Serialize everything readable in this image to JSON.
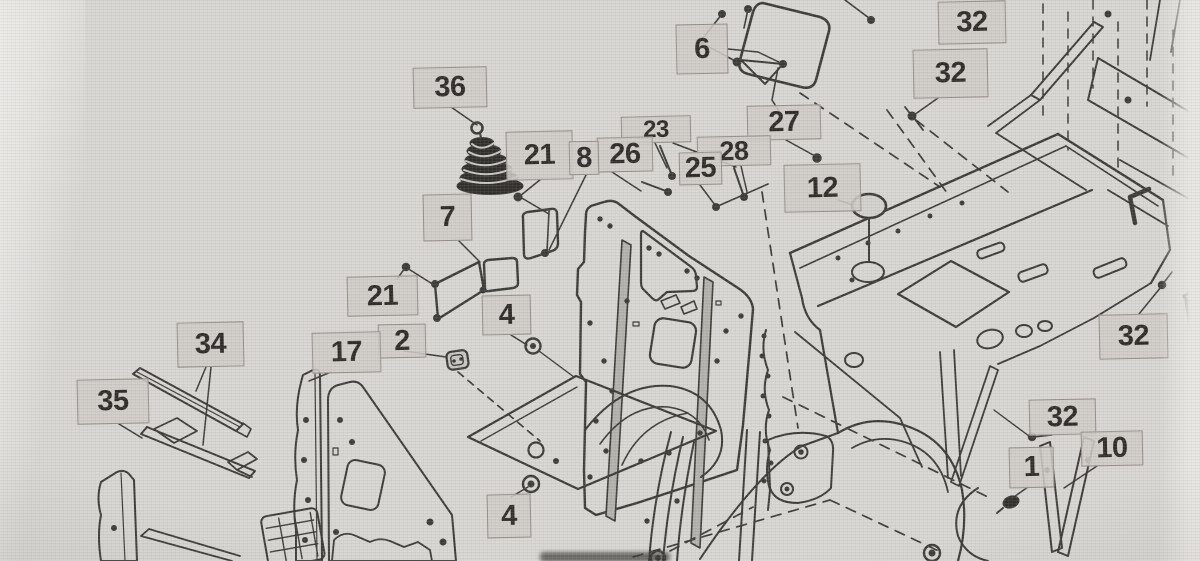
{
  "colors": {
    "background": "#d8d6d2",
    "line": "#3b3a36",
    "dark_fill": "#2f2e2b",
    "label_bg": "rgba(206,203,198,0.88)",
    "label_border": "#94918b",
    "label_text": "#2c2b28"
  },
  "labels": [
    {
      "id": "6",
      "text": "6",
      "x": 676,
      "y": 24,
      "w": 52,
      "h": 50
    },
    {
      "id": "32-top",
      "text": "32",
      "x": 938,
      "y": 1,
      "w": 68,
      "h": 43
    },
    {
      "id": "32-upper-right",
      "text": "32",
      "x": 913,
      "y": 49,
      "w": 75,
      "h": 49
    },
    {
      "id": "36",
      "text": "36",
      "x": 413,
      "y": 67,
      "w": 74,
      "h": 41
    },
    {
      "id": "27",
      "text": "27",
      "x": 747,
      "y": 105,
      "w": 74,
      "h": 35
    },
    {
      "id": "23",
      "text": "23",
      "x": 621,
      "y": 116,
      "w": 70,
      "h": 27
    },
    {
      "id": "26",
      "text": "26",
      "x": 597,
      "y": 137,
      "w": 56,
      "h": 35
    },
    {
      "id": "28",
      "text": "28",
      "x": 697,
      "y": 136,
      "w": 74,
      "h": 30
    },
    {
      "id": "25",
      "text": "25",
      "x": 679,
      "y": 152,
      "w": 43,
      "h": 33
    },
    {
      "id": "21-upper",
      "text": "21",
      "x": 506,
      "y": 131,
      "w": 67,
      "h": 49
    },
    {
      "id": "8",
      "text": "8",
      "x": 569,
      "y": 141,
      "w": 30,
      "h": 34
    },
    {
      "id": "12",
      "text": "12",
      "x": 784,
      "y": 164,
      "w": 77,
      "h": 48
    },
    {
      "id": "7",
      "text": "7",
      "x": 423,
      "y": 194,
      "w": 49,
      "h": 47
    },
    {
      "id": "21-lower",
      "text": "21",
      "x": 347,
      "y": 276,
      "w": 71,
      "h": 40
    },
    {
      "id": "4-upper",
      "text": "4",
      "x": 482,
      "y": 295,
      "w": 49,
      "h": 40
    },
    {
      "id": "2",
      "text": "2",
      "x": 378,
      "y": 324,
      "w": 48,
      "h": 34
    },
    {
      "id": "34",
      "text": "34",
      "x": 177,
      "y": 322,
      "w": 67,
      "h": 45
    },
    {
      "id": "17",
      "text": "17",
      "x": 312,
      "y": 332,
      "w": 69,
      "h": 41
    },
    {
      "id": "35",
      "text": "35",
      "x": 77,
      "y": 379,
      "w": 72,
      "h": 45
    },
    {
      "id": "4-lower",
      "text": "4",
      "x": 487,
      "y": 494,
      "w": 44,
      "h": 44
    },
    {
      "id": "32-mid-right",
      "text": "32",
      "x": 1099,
      "y": 314,
      "w": 69,
      "h": 45
    },
    {
      "id": "32-lower-right",
      "text": "32",
      "x": 1029,
      "y": 399,
      "w": 67,
      "h": 36
    },
    {
      "id": "1",
      "text": "1",
      "x": 1009,
      "y": 447,
      "w": 45,
      "h": 41
    },
    {
      "id": "10",
      "text": "10",
      "x": 1081,
      "y": 431,
      "w": 62,
      "h": 35
    }
  ]
}
